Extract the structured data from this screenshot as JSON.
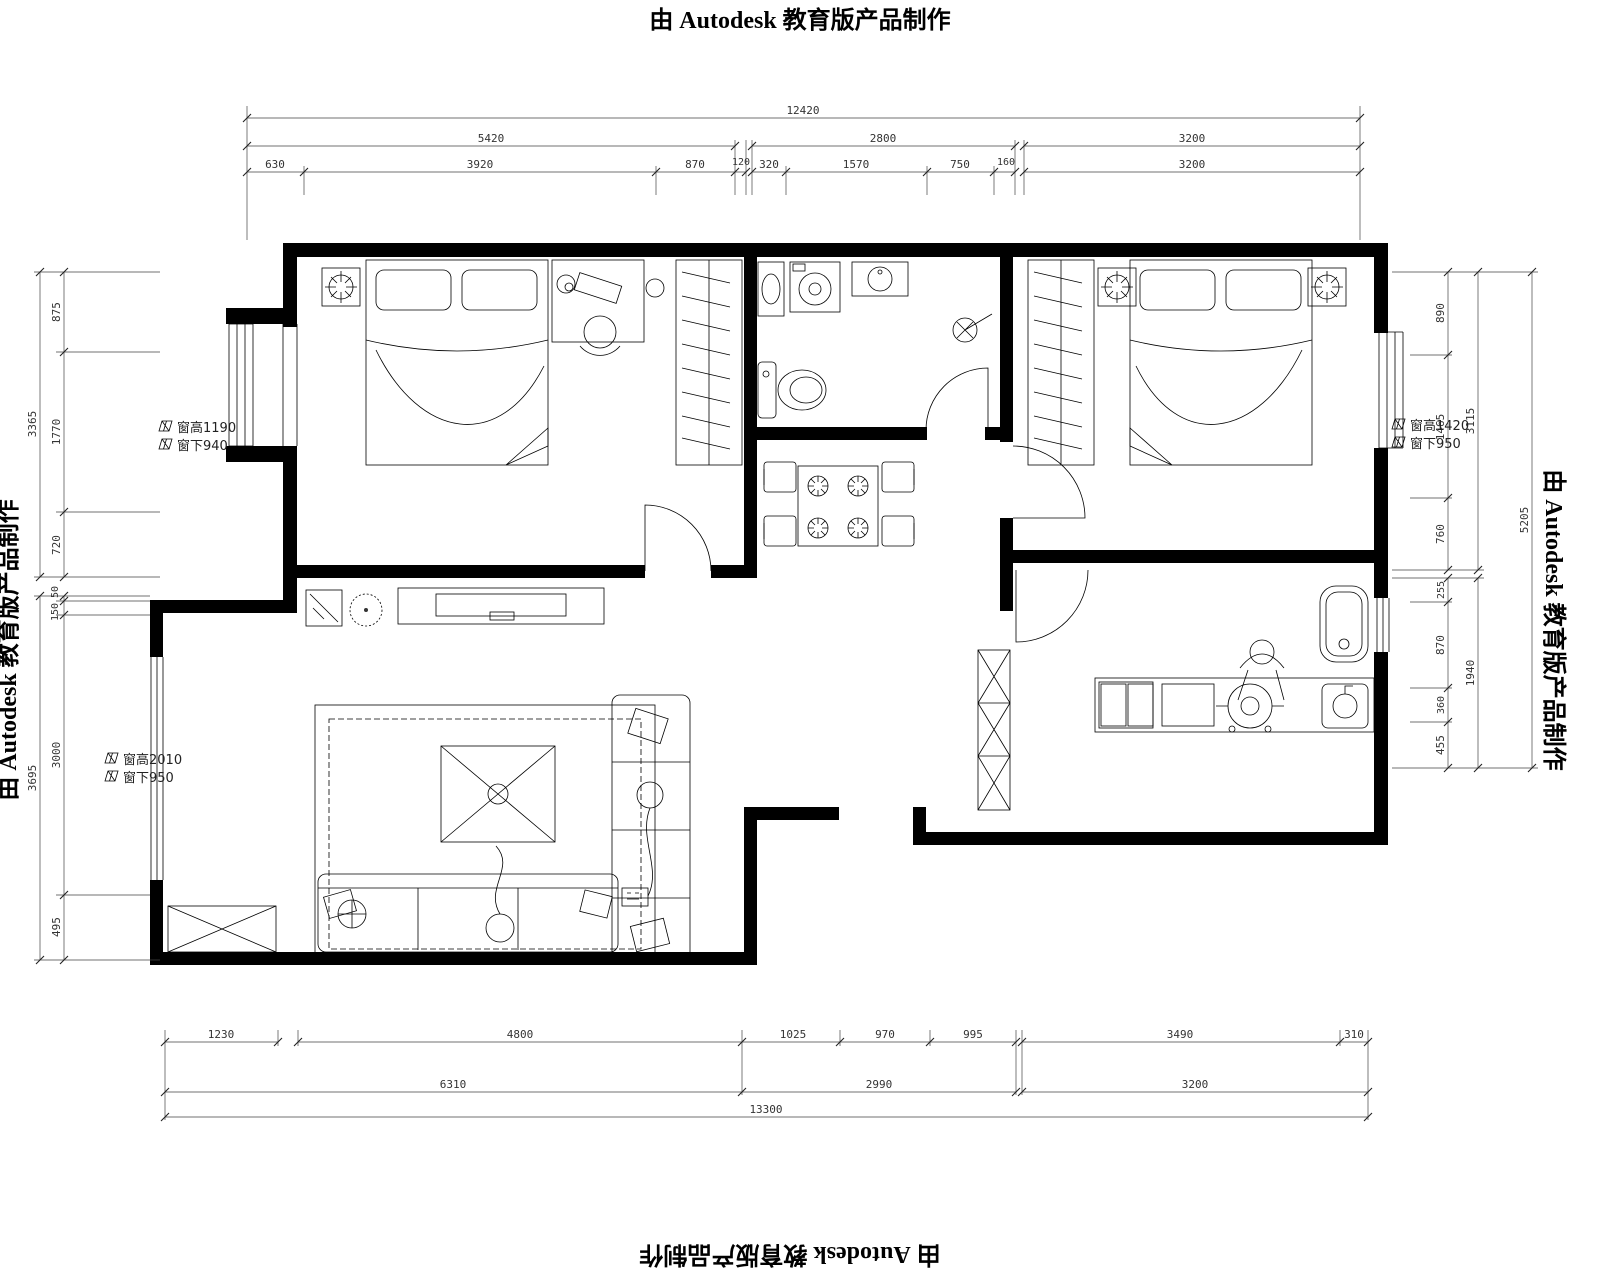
{
  "watermark": "由 Autodesk 教育版产品制作",
  "dims": {
    "top": {
      "total": "12420",
      "majors": [
        "5420",
        "2800",
        "3200"
      ],
      "minors": [
        "630",
        "3920",
        "870",
        "120",
        "320",
        "1570",
        "750",
        "160",
        "3200"
      ]
    },
    "bottom": {
      "minors": [
        "1230",
        "4800",
        "1025",
        "970",
        "995",
        "3490",
        "310"
      ],
      "majors": [
        "6310",
        "2990",
        "3200"
      ],
      "total": "13300"
    },
    "left": {
      "minors": [
        "875",
        "1770",
        "720",
        "50",
        "150",
        "3000",
        "495"
      ],
      "majors": [
        "3365",
        "3695"
      ]
    },
    "right": {
      "minors": [
        "890",
        "1465",
        "760",
        "255",
        "870",
        "360",
        "455"
      ],
      "majors": [
        "3115",
        "1940"
      ],
      "total": "5205"
    }
  },
  "window_notes": [
    {
      "line1": "窗高1190",
      "line2": "窗下940"
    },
    {
      "line1": "窗高2010",
      "line2": "窗下950"
    },
    {
      "line1": "窗高1420",
      "line2": "窗下950"
    }
  ]
}
